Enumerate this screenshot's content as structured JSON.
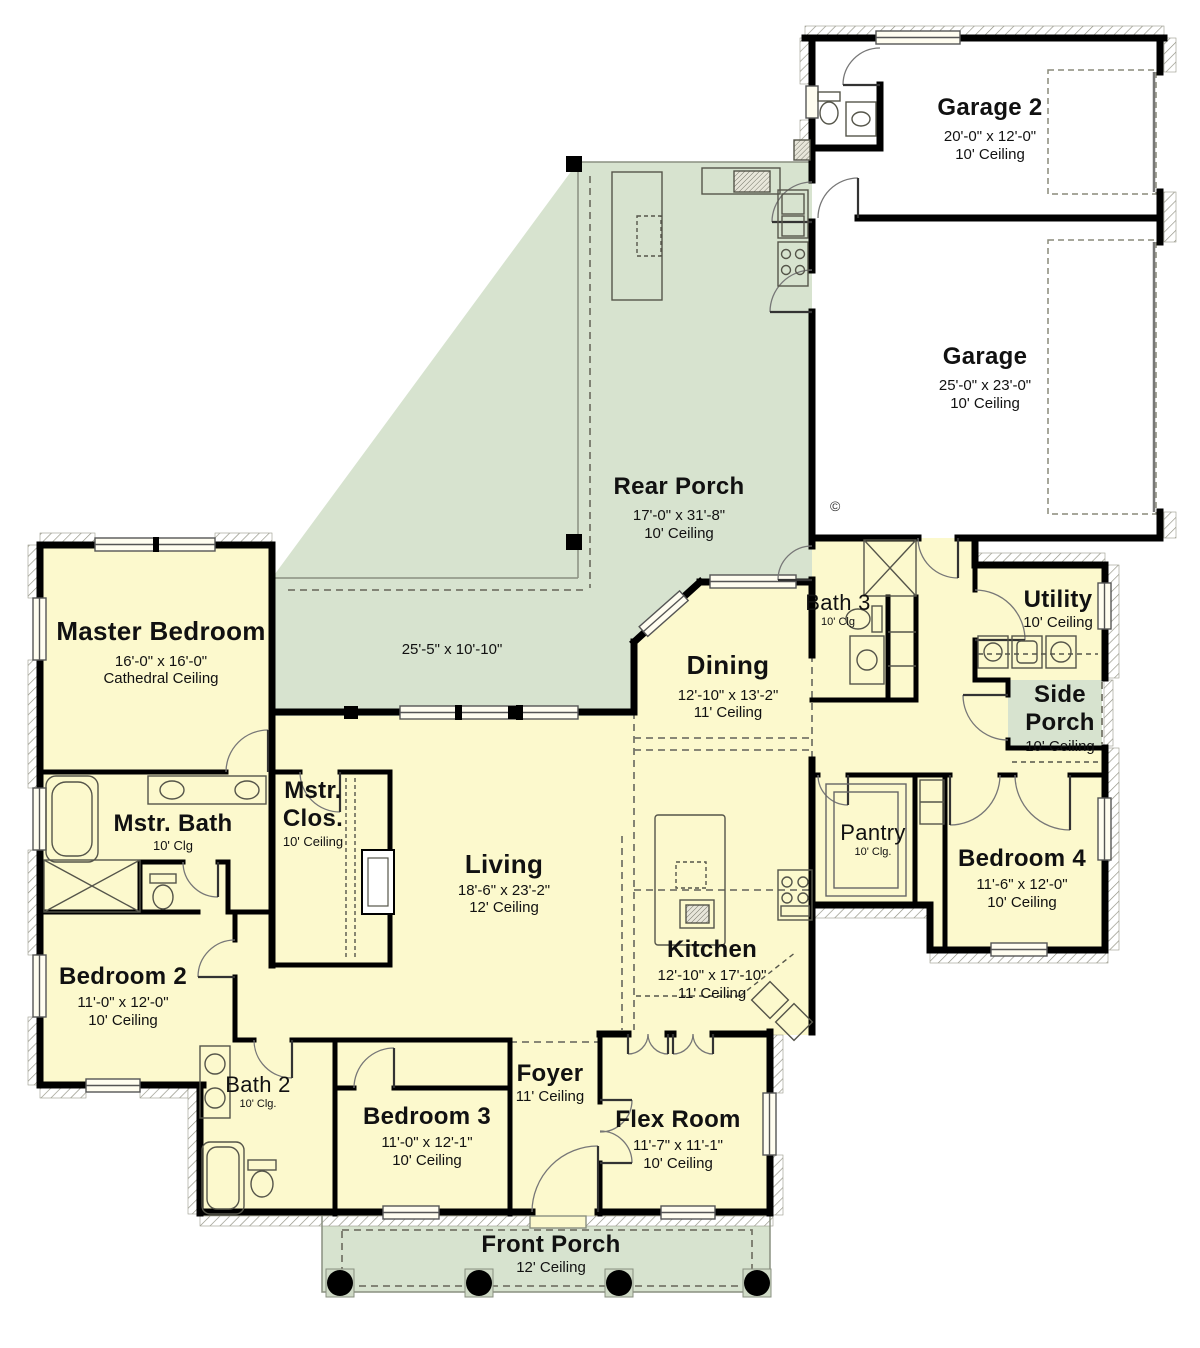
{
  "colors": {
    "room_fill": "#fcf9cd",
    "porch_fill": "#d7e3cf",
    "wall": "#000000",
    "fixture_line": "#55554a",
    "window_fill": "#fffdf0"
  },
  "rooms": {
    "garage2": {
      "name": "Garage 2",
      "dims": "20'-0\" x 12'-0\"",
      "ceiling": "10' Ceiling"
    },
    "garage": {
      "name": "Garage",
      "dims": "25'-0\" x 23'-0\"",
      "ceiling": "10' Ceiling"
    },
    "rear_porch": {
      "name": "Rear Porch",
      "dims": "17'-0\" x 31'-8\"",
      "ceiling": "10' Ceiling"
    },
    "master_bedroom": {
      "name": "Master Bedroom",
      "dims": "16'-0\" x 16'-0\"",
      "ceiling": "Cathedral Ceiling"
    },
    "dining": {
      "name": "Dining",
      "dims": "12'-10\" x 13'-2\"",
      "ceiling": "11' Ceiling"
    },
    "bath3": {
      "name": "Bath 3",
      "ceiling": "10' Clg"
    },
    "utility": {
      "name": "Utility",
      "ceiling": "10' Ceiling"
    },
    "side_porch": {
      "name": "Side Porch",
      "ceiling": "10' Ceiling"
    },
    "mstr_bath": {
      "name": "Mstr. Bath",
      "ceiling": "10' Clg"
    },
    "mstr_clos": {
      "name": "Mstr. Clos.",
      "ceiling": "10' Ceiling"
    },
    "living": {
      "name": "Living",
      "dims": "18'-6\" x 23'-2\"",
      "ceiling": "12' Ceiling"
    },
    "pantry": {
      "name": "Pantry",
      "ceiling": "10' Clg."
    },
    "bedroom4": {
      "name": "Bedroom 4",
      "dims": "11'-6\" x 12'-0\"",
      "ceiling": "10' Ceiling"
    },
    "bedroom2": {
      "name": "Bedroom 2",
      "dims": "11'-0\" x 12'-0\"",
      "ceiling": "10' Ceiling"
    },
    "kitchen": {
      "name": "Kitchen",
      "dims": "12'-10\" x 17'-10\"",
      "ceiling": "11' Ceiling"
    },
    "bath2": {
      "name": "Bath 2",
      "ceiling": "10' Clg."
    },
    "bedroom3": {
      "name": "Bedroom 3",
      "dims": "11'-0\" x 12'-1\"",
      "ceiling": "10' Ceiling"
    },
    "foyer": {
      "name": "Foyer",
      "ceiling": "11' Ceiling"
    },
    "flex_room": {
      "name": "Flex Room",
      "dims": "11'-7\" x 11'-1\"",
      "ceiling": "10' Ceiling"
    },
    "front_porch": {
      "name": "Front Porch",
      "ceiling": "12' Ceiling"
    }
  },
  "annotations": {
    "rear_porch_extension_dims": "25'-5\" x 10'-10\"",
    "copyright_symbol": "©"
  }
}
